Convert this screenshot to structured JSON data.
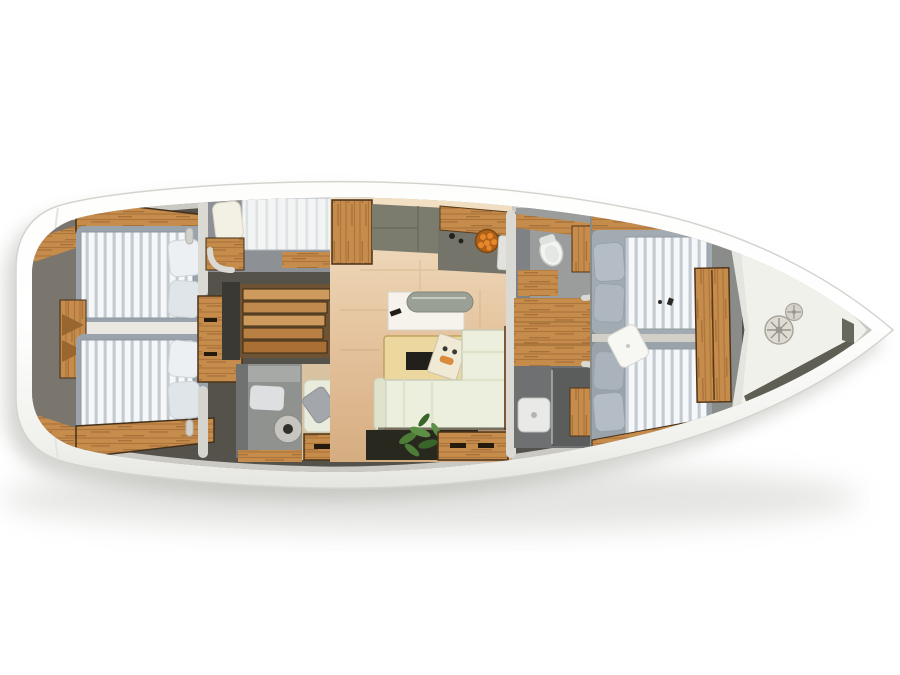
{
  "meta": {
    "title": "Sailing yacht interior deck plan — top-down 3D render",
    "canvas_width": "900",
    "canvas_height": "675"
  },
  "colors": {
    "bg": "#ffffff",
    "shadow": "#a9a9a3",
    "hullEdge": "#d4d4cf",
    "hullTop": "#fdfdfc",
    "hullLow": "#e1e1dc",
    "deckBase": "#55524b",
    "deckRim": "#cbc9c3",
    "wall": "#dbd9d3",
    "wood1": "#c68c4c",
    "wood2": "#9a6630",
    "wood3": "#6f4519",
    "woodDark": "#42301a",
    "woodLight": "#d9a868",
    "stairBg": "#6d5233",
    "mattA": "#f5f7f8",
    "mattB": "#c3cad2",
    "mattFrame": "#9aa3ac",
    "mattFrameFwd": "#a3abb2",
    "pillow": "#edf0f2",
    "pillowShade": "#e0e5e9",
    "pillowFwd": "#b4bcc5",
    "pillowCream": "#f3f0e4",
    "grayRoom": "#90928f",
    "grayRoomDark": "#77797a",
    "grayFloor": "#8d9095",
    "counter": "#7c7c6e",
    "counterDark": "#6a6a5e",
    "floorA": "#f2e0c4",
    "floorB": "#e4c29c",
    "floorC": "#d5ac80",
    "sofa": "#edefde",
    "sofaShade": "#dfe3cc",
    "sofaEdge": "#c9cdb6",
    "table": "#ecd89e",
    "tableEdge": "#c0a25e",
    "tableInset": "#22201a",
    "white": "#f4f5f3",
    "toiletRim": "#c9ccc8",
    "roll": "#9ba094",
    "soil": "#29281f",
    "leaf1": "#4d7c38",
    "leaf2": "#39642a",
    "leaf3": "#5d8f46",
    "orange": "#e6872a",
    "orangeDark": "#b06018",
    "bowlRim": "#7c4812",
    "bowDeck": "#f1f1ec",
    "groove": "#5e5e55",
    "grooveLight": "#b9b9b2",
    "winch": "#dddbd2",
    "winchEdge": "#a8a69c",
    "winchDetail": "#8a887e",
    "dark": "#2c2a25",
    "shower": "#6e7071",
    "showerFloor": "#5b5d5c",
    "laptop": "#1c1c1a",
    "paper": "#f1eee4",
    "magazine": "#efe9d6"
  },
  "scene": {
    "vessel": "sailing-yacht-deck-plan",
    "orientation": "bow-right-stern-left",
    "regions": [
      "aft-cabin-port",
      "aft-cabin-starboard",
      "mid-single-berth",
      "companionway-stairs",
      "aft-head",
      "nav-station",
      "galley",
      "saloon",
      "forward-head",
      "forward-shower",
      "forward-cabin",
      "bow-anchor-locker"
    ]
  }
}
